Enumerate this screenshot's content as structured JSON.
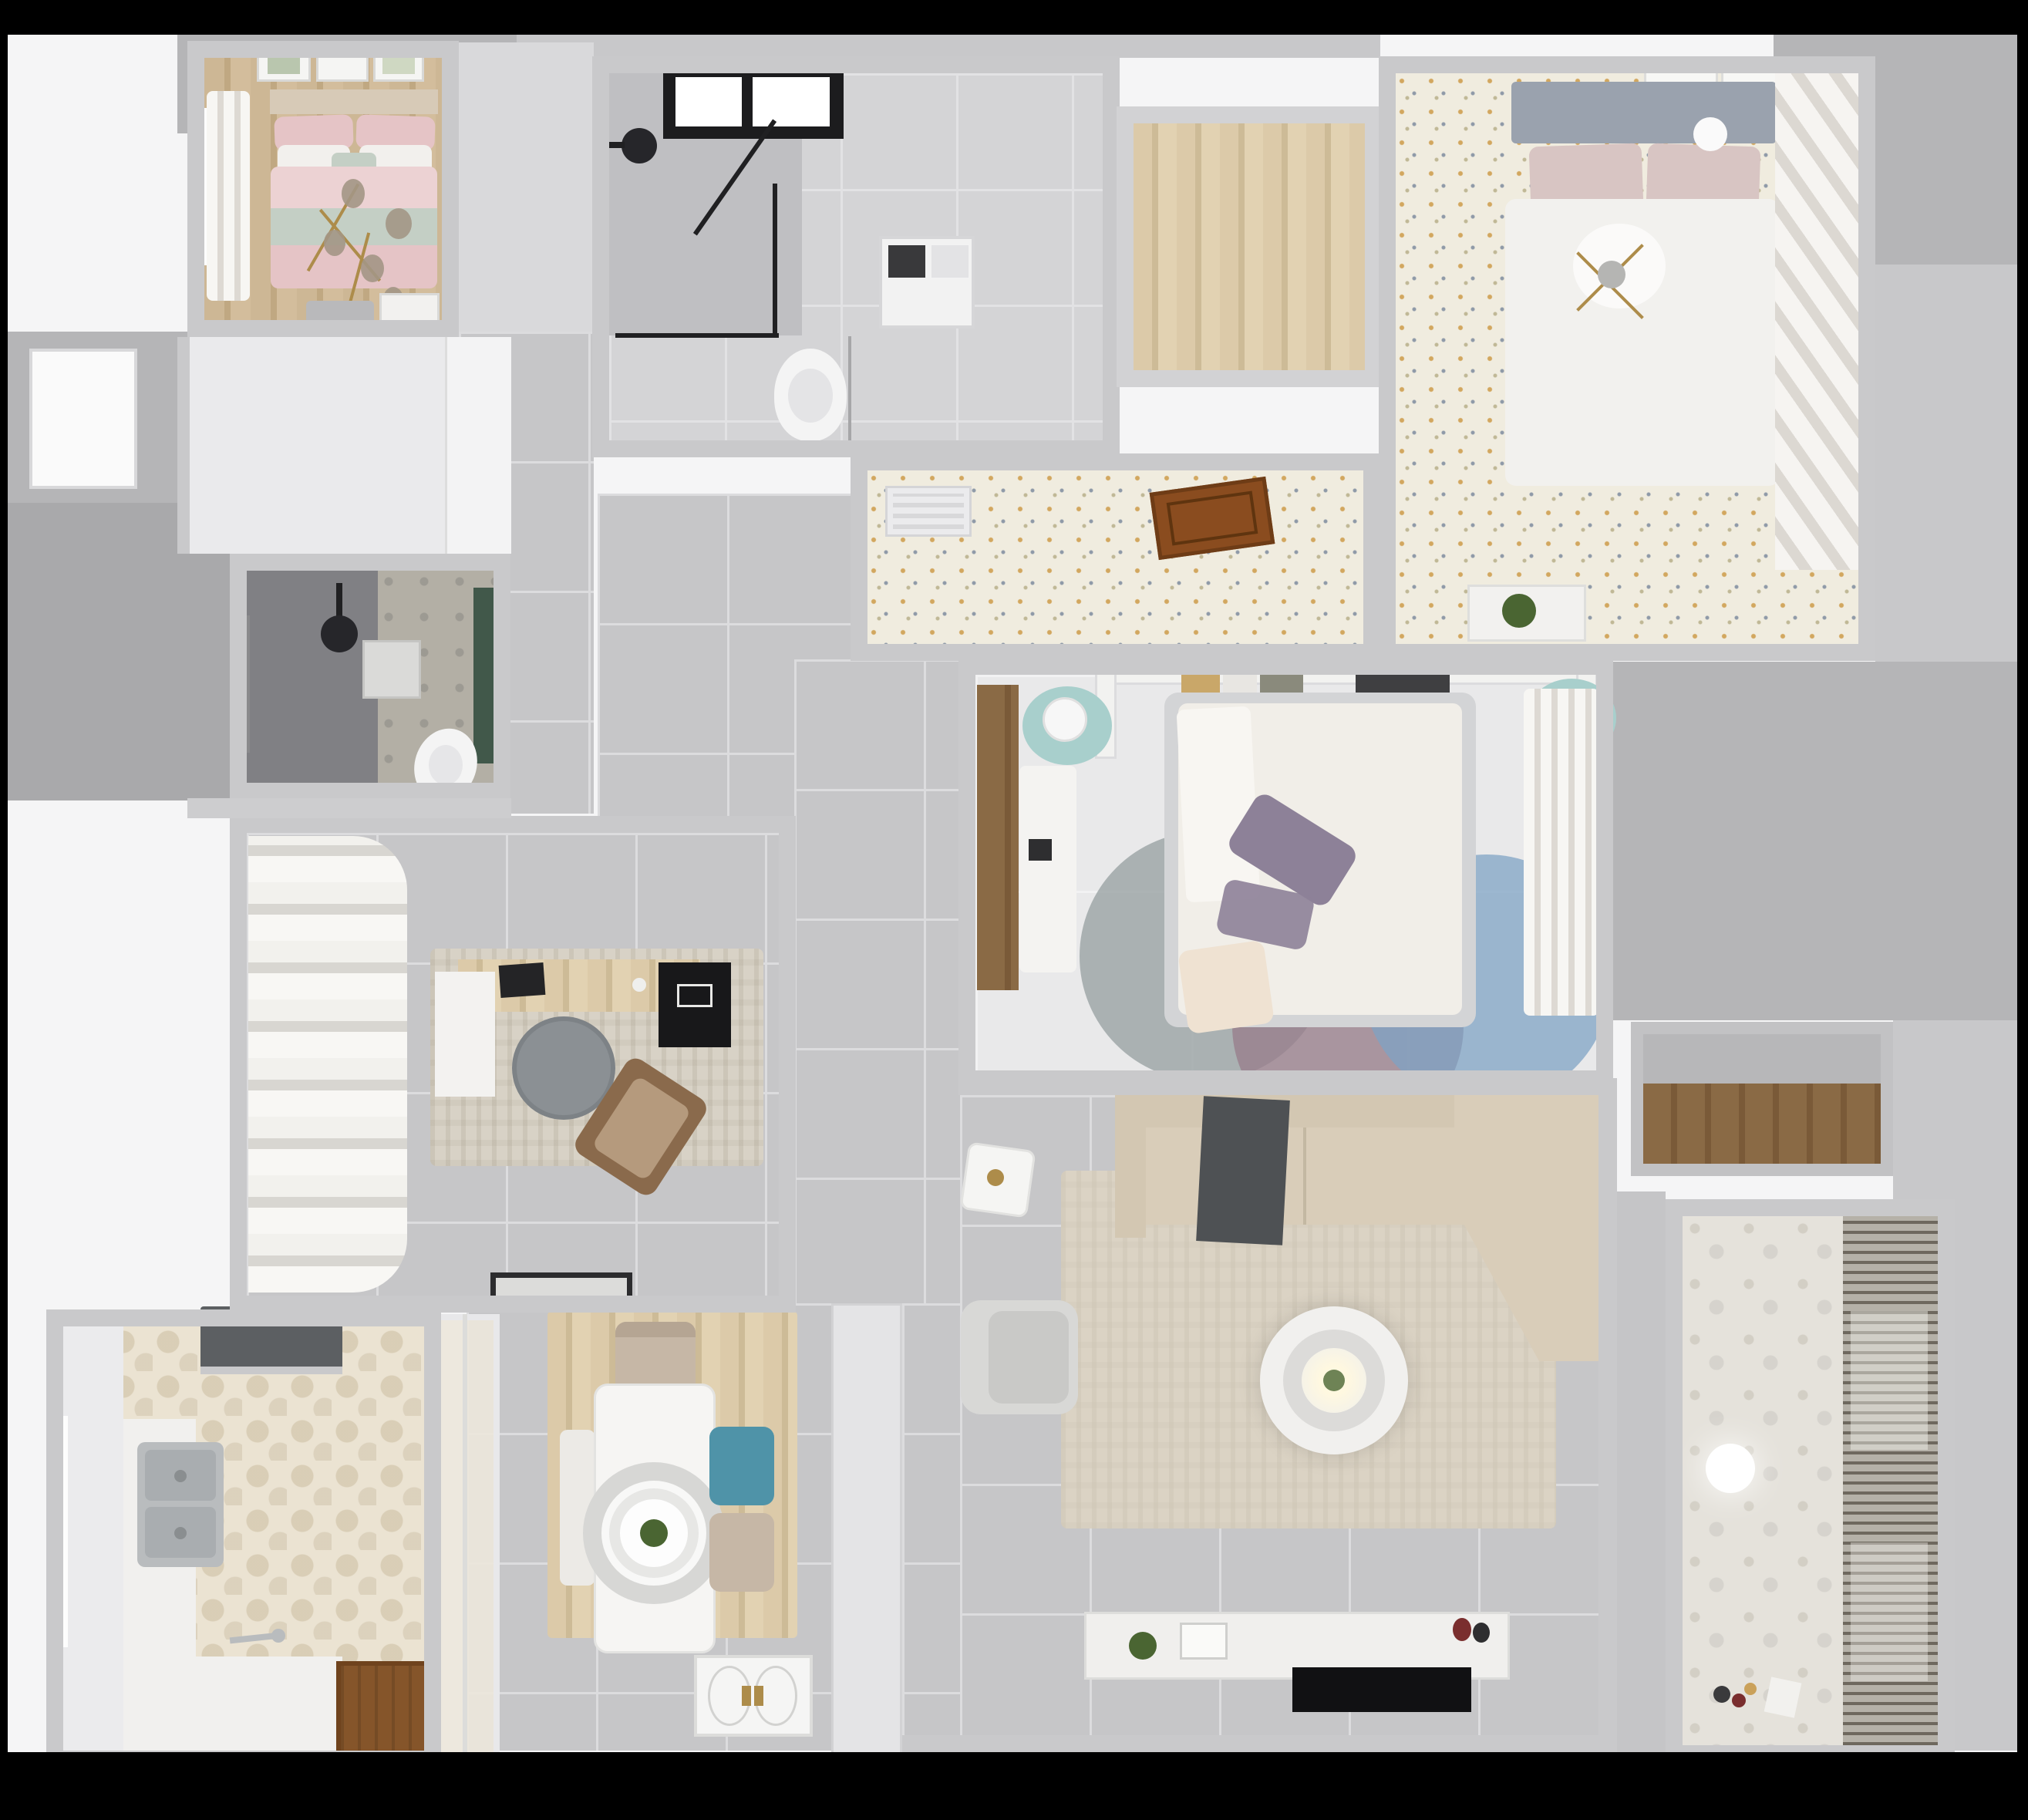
{
  "scene": {
    "title": "apartment-3d-floor-plan-top-down-render",
    "visible_text": [],
    "view": "top-down orthographic 3D render"
  },
  "palette": {
    "wall": "#c9c9cb",
    "wall_light": "#d9d9db",
    "exterior": "#f5f5f6",
    "slab_gray": "#b5b5b7",
    "slab_gray2": "#c8c8ca",
    "slab_dark": "#a9a9ab",
    "bed1_headboard": "#d7cab7",
    "bed1_pillow_pink": "#e5c4c6",
    "bed1_mint": "#c4cfc5",
    "bed1_duvet_pink": "#ecd2d3",
    "chandelier_gold": "#ad8c4a",
    "chandelier_glass": "#a39685",
    "shower_black": "#26262a",
    "toilet_white": "#f4f4f4",
    "washer_white": "#f2f2f2",
    "bed2_headboard_gray": "#9aa2ae",
    "bed2_pillow": "#d8c5c3",
    "bed2_duvet": "#f2f1ee",
    "vent_white": "#ebebed",
    "door_open_brown": "#8a4c1f",
    "bed3_frame": "#d3d4d6",
    "bed3_duvet": "#f1eee8",
    "pillow_purple": "#8d8198",
    "pillow_cream": "#efe2d2",
    "pouf_teal": "#a8cfcc",
    "lamp_white": "#f7f7f7",
    "rug_round_gray": "#9aa3a4",
    "rug_round_mauve": "#997f8c",
    "rug_round_blue": "#7fa3c4",
    "sofa_beige": "#d3c7b2",
    "sofa_seat": "#d9cdb9",
    "throw_dark": "#4e5154",
    "rug_living": "#dbd3c4",
    "armchair_gray": "#d8d8d6",
    "console_white": "#f0efed",
    "tv_black": "#111113",
    "plant_green": "#4a6532",
    "table_white": "#f6f5f3",
    "chair_beige": "#c6b7a6",
    "chair_blue": "#4f93a8",
    "bench_white": "#eceae6",
    "hood_dark": "#5c5f62",
    "sink_steel": "#b9bcbe",
    "counter_white": "#f1f0ee",
    "door_wood": "#85552a",
    "bath2_pattern": "#b3afa5",
    "bath2_green": "#41584a",
    "chair_round_gray": "#8b9094",
    "lounge_wood": "#8a6a4c",
    "lounge_seat": "#b59a7d",
    "mat_light": "#dcdcda"
  },
  "rooms": [
    {
      "id": "bedroom-1",
      "label": "Bedroom 1 (pink bed)",
      "floor": "wood"
    },
    {
      "id": "bathroom-1",
      "label": "Bathroom 1 (shower + laundry)",
      "floor": "gray-tile"
    },
    {
      "id": "walk-in-closet",
      "label": "Walk-in closet",
      "floor": "wood"
    },
    {
      "id": "bedroom-2",
      "label": "Bedroom 2 (gray headboard)",
      "floor": "floral-speckle"
    },
    {
      "id": "hallway-upper",
      "label": "Hallway",
      "floor": "floral-speckle"
    },
    {
      "id": "bedroom-3",
      "label": "Bedroom 3 (middle)",
      "floor": "light-tile"
    },
    {
      "id": "bathroom-2",
      "label": "Bathroom 2 (dark tile)",
      "floor": "dark-tile"
    },
    {
      "id": "study",
      "label": "Study",
      "floor": "gray-tile"
    },
    {
      "id": "kitchen",
      "label": "Kitchen",
      "floor": "hex-tile"
    },
    {
      "id": "dining",
      "label": "Dining area",
      "floor": "gray-tile"
    },
    {
      "id": "living",
      "label": "Living room",
      "floor": "gray-tile"
    },
    {
      "id": "balcony",
      "label": "Balcony / laundry",
      "floor": "pattern-tile"
    },
    {
      "id": "storage-niche",
      "label": "Storage niche",
      "floor": "wood"
    }
  ],
  "furniture": {
    "bedroom-1": [
      "wall art x3",
      "curtains",
      "double bed with pink bedding",
      "mint throw band",
      "gold chandelier",
      "bench",
      "dresser"
    ],
    "bathroom-1": [
      "skylight",
      "corner shower with black frame",
      "black shower head",
      "washing machine",
      "toilet"
    ],
    "bedroom-2": [
      "wall art",
      "gray tufted headboard bed",
      "white duvet",
      "ball lamp",
      "chandelier",
      "slatted wardrobe",
      "plant console"
    ],
    "hallway-upper": [
      "vent grille",
      "open wooden door"
    ],
    "bedroom-3": [
      "headboard shelf with books",
      "two teal poufs with lamps",
      "white desk",
      "bed with floral duvet",
      "purple pillows",
      "three round rugs",
      "sheer curtain wardrobe"
    ],
    "bathroom-2": [
      "window",
      "ceiling shower head",
      "wall art",
      "toilet",
      "green accent strip"
    ],
    "study": [
      "curtain wall",
      "area rug",
      "wooden desk",
      "laptop",
      "round chair",
      "lounge chair",
      "doormat"
    ],
    "kitchen": [
      "range hood",
      "double sink",
      "counters",
      "window",
      "wooden door"
    ],
    "dining": [
      "wood area rug",
      "white dining table",
      "pendant ring lamp with plant",
      "beige chairs x2",
      "blue chair",
      "bench"
    ],
    "living": [
      "sectional sofa",
      "dark throw",
      "side table",
      "area rug",
      "ring coffee table",
      "armchair",
      "TV console",
      "TV",
      "entry door with gold handles"
    ],
    "balcony": [
      "vertical blinds / drying rack",
      "globe lamp",
      "toys"
    ]
  }
}
